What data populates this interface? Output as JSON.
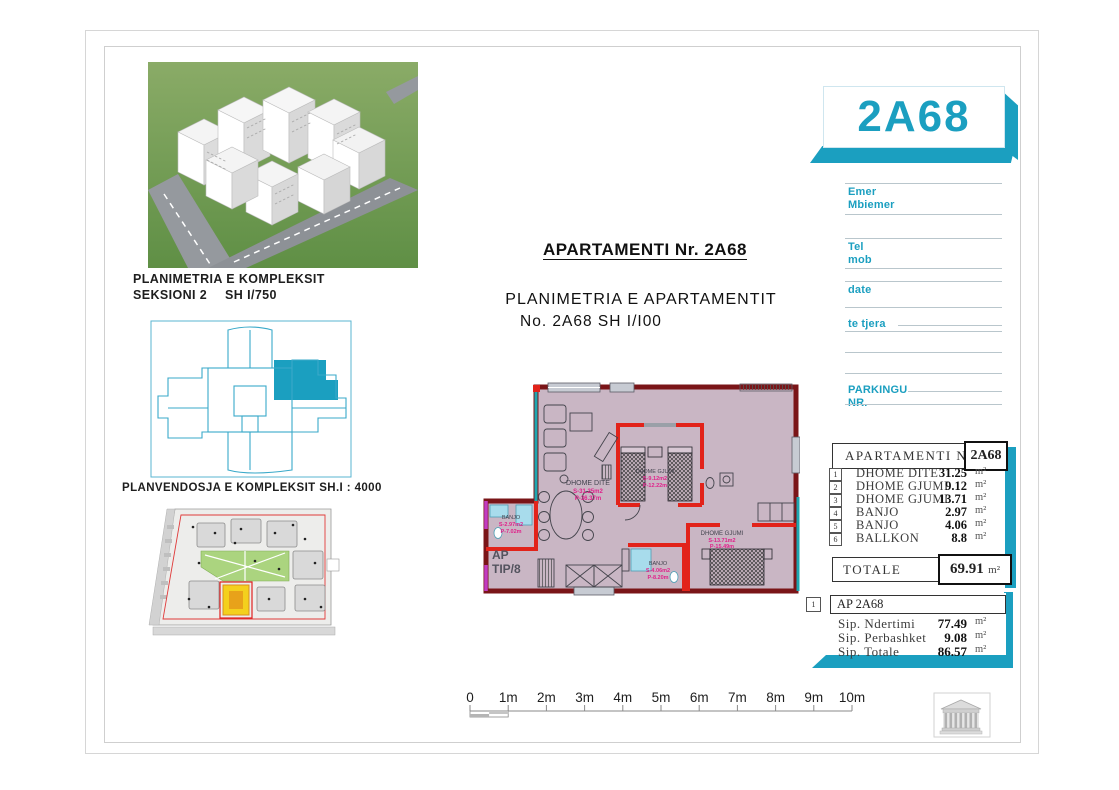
{
  "colors": {
    "accent": "#1b9fc0",
    "wall_dark": "#7a1518",
    "wall_red": "#e2231a",
    "floor": "#c9b6c4",
    "teal": "#1fa7b0",
    "magenta": "#c23bc2",
    "site_green": "#abd47f",
    "site_yellow": "#f4d01d"
  },
  "card": {
    "label": "2A68"
  },
  "captions": {
    "complex_line1": "PLANIMETRIA E KOMPLEKSIT",
    "complex_line2a": "SEKSIONI 2",
    "complex_line2b": "SH I/750",
    "siteplan": "PLANVENDOSJA E KOMPLEKSIT SH.I : 4000"
  },
  "titles": {
    "main": "APARTAMENTI Nr. 2A68",
    "sub1": "PLANIMETRIA E APARTAMENTIT",
    "sub2": "No. 2A68 SH I/I00"
  },
  "form": {
    "labels": [
      "Emer",
      "Mbiemer",
      "Tel",
      "mob",
      "date",
      "te tjera",
      "PARKINGU",
      "NR."
    ]
  },
  "area_table": {
    "header_label": "APARTAMENTI NR.",
    "header_value": "2A68",
    "rows": [
      {
        "num": "1",
        "label": "DHOME DITE",
        "value": "31.25",
        "unit": "m²"
      },
      {
        "num": "2",
        "label": "DHOME GJUMI",
        "value": "9.12",
        "unit": "m²"
      },
      {
        "num": "3",
        "label": "DHOME GJUMI",
        "value": "13.71",
        "unit": "m²"
      },
      {
        "num": "4",
        "label": "BANJO",
        "value": "2.97",
        "unit": "m²"
      },
      {
        "num": "5",
        "label": "BANJO",
        "value": "4.06",
        "unit": "m²"
      },
      {
        "num": "6",
        "label": "BALLKON",
        "value": "8.8",
        "unit": "m²"
      }
    ],
    "total_label": "TOTALE",
    "total_value": "69.91",
    "total_unit": "m²"
  },
  "summary": {
    "index": "1",
    "header": "AP 2A68",
    "rows": [
      {
        "label": "Sip. Ndertimi",
        "value": "77.49",
        "unit": "m²"
      },
      {
        "label": "Sip. Perbashket",
        "value": "9.08",
        "unit": "m²"
      },
      {
        "label": "Sip. Totale",
        "value": "86.57",
        "unit": "m²"
      }
    ]
  },
  "floor_plan": {
    "type_label_1": "AP",
    "type_label_2": "TIP/8",
    "rooms": [
      {
        "name": "DHOME DITE",
        "area": "S-31.25m2",
        "line2": "P-36.37m"
      },
      {
        "name": "DHOME GJUMI",
        "area": "S-9.12m2",
        "line2": "P-12.22m"
      },
      {
        "name": "DHOME GJUMI",
        "area": "S-13.71m2",
        "line2": "P-15.49m"
      },
      {
        "name": "BANJO",
        "area": "S-2.97m2",
        "line2": "P-7.02m"
      },
      {
        "name": "BANJO",
        "area": "S-4.06m2",
        "line2": "P-8.20m"
      }
    ]
  },
  "scale_bar": {
    "labels": [
      "0",
      "1m",
      "2m",
      "3m",
      "4m",
      "5m",
      "6m",
      "7m",
      "8m",
      "9m",
      "10m"
    ]
  }
}
